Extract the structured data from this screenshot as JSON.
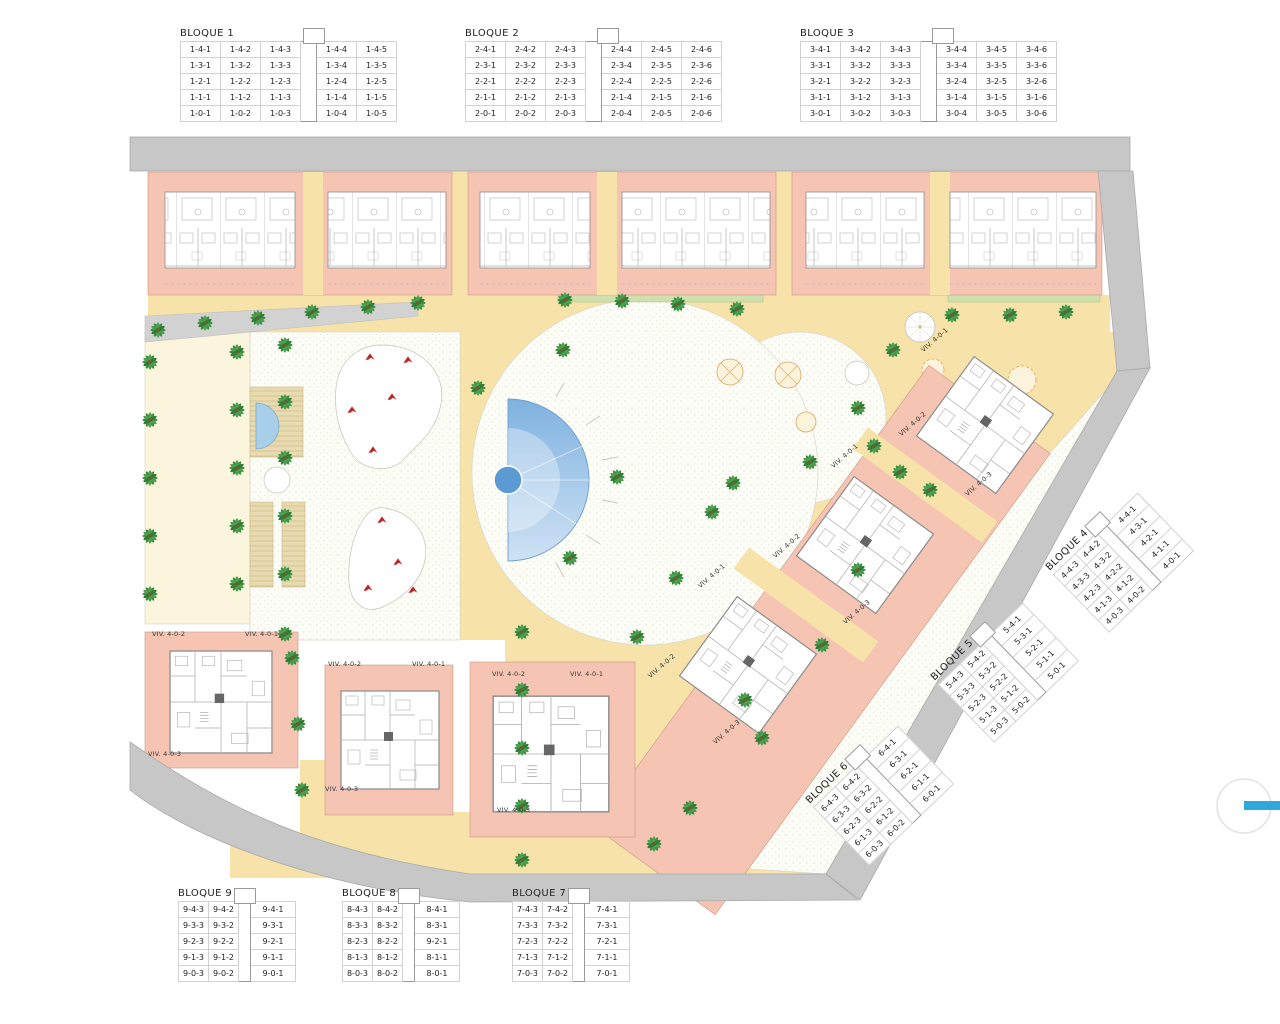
{
  "palette": {
    "pink": "#f6c4b2",
    "sand": "#f7e3a9",
    "road": "#c7c7c7",
    "lawn": "#fbf5dd",
    "deck": "#e9dbb0",
    "hedge": "#cde0ae",
    "pool_dark": "#7fb2e0",
    "pool_light": "#cfe2f4",
    "palm_green": "#3e8e41",
    "play_red": "#c22222",
    "accent_blue": "#2fa8dd"
  },
  "tables": [
    {
      "id": "b1",
      "title": "BLOQUE 1",
      "kind": "wide",
      "gap_after": 3,
      "rows": [
        [
          "1-4-1",
          "1-4-2",
          "1-4-3",
          "1-4-4",
          "1-4-5"
        ],
        [
          "1-3-1",
          "1-3-2",
          "1-3-3",
          "1-3-4",
          "1-3-5"
        ],
        [
          "1-2-1",
          "1-2-2",
          "1-2-3",
          "1-2-4",
          "1-2-5"
        ],
        [
          "1-1-1",
          "1-1-2",
          "1-1-3",
          "1-1-4",
          "1-1-5"
        ],
        [
          "1-0-1",
          "1-0-2",
          "1-0-3",
          "1-0-4",
          "1-0-5"
        ]
      ]
    },
    {
      "id": "b2",
      "title": "BLOQUE 2",
      "kind": "wide",
      "gap_after": 3,
      "rows": [
        [
          "2-4-1",
          "2-4-2",
          "2-4-3",
          "2-4-4",
          "2-4-5",
          "2-4-6"
        ],
        [
          "2-3-1",
          "2-3-2",
          "2-3-3",
          "2-3-4",
          "2-3-5",
          "2-3-6"
        ],
        [
          "2-2-1",
          "2-2-2",
          "2-2-3",
          "2-2-4",
          "2-2-5",
          "2-2-6"
        ],
        [
          "2-1-1",
          "2-1-2",
          "2-1-3",
          "2-1-4",
          "2-1-5",
          "2-1-6"
        ],
        [
          "2-0-1",
          "2-0-2",
          "2-0-3",
          "2-0-4",
          "2-0-5",
          "2-0-6"
        ]
      ]
    },
    {
      "id": "b3",
      "title": "BLOQUE 3",
      "kind": "wide",
      "gap_after": 3,
      "rows": [
        [
          "3-4-1",
          "3-4-2",
          "3-4-3",
          "3-4-4",
          "3-4-5",
          "3-4-6"
        ],
        [
          "3-3-1",
          "3-3-2",
          "3-3-3",
          "3-3-4",
          "3-3-5",
          "3-3-6"
        ],
        [
          "3-2-1",
          "3-2-2",
          "3-2-3",
          "3-2-4",
          "3-2-5",
          "3-2-6"
        ],
        [
          "3-1-1",
          "3-1-2",
          "3-1-3",
          "3-1-4",
          "3-1-5",
          "3-1-6"
        ],
        [
          "3-0-1",
          "3-0-2",
          "3-0-3",
          "3-0-4",
          "3-0-5",
          "3-0-6"
        ]
      ]
    },
    {
      "id": "b4",
      "title": "BLOQUE 4",
      "kind": "small",
      "gap_after": 2,
      "rows": [
        [
          "4-4-3",
          "4-4-2",
          "4-4-1"
        ],
        [
          "4-3-3",
          "4-3-2",
          "4-3-1"
        ],
        [
          "4-2-3",
          "4-2-2",
          "4-2-1"
        ],
        [
          "4-1-3",
          "4-1-2",
          "4-1-1"
        ],
        [
          "4-0-3",
          "4-0-2",
          "4-0-1"
        ]
      ]
    },
    {
      "id": "b5",
      "title": "BLOQUE 5",
      "kind": "small",
      "gap_after": 2,
      "rows": [
        [
          "5-4-3",
          "5-4-2",
          "5-4-1"
        ],
        [
          "5-3-3",
          "5-3-2",
          "5-3-1"
        ],
        [
          "5-2-3",
          "5-2-2",
          "5-2-1"
        ],
        [
          "5-1-3",
          "5-1-2",
          "5-1-1"
        ],
        [
          "5-0-3",
          "5-0-2",
          "5-0-1"
        ]
      ]
    },
    {
      "id": "b6",
      "title": "BLOQUE 6",
      "kind": "small",
      "gap_after": 2,
      "rows": [
        [
          "6-4-3",
          "6-4-2",
          "6-4-1"
        ],
        [
          "6-3-3",
          "6-3-2",
          "6-3-1"
        ],
        [
          "6-2-3",
          "6-2-2",
          "6-2-1"
        ],
        [
          "6-1-3",
          "6-1-2",
          "6-1-1"
        ],
        [
          "6-0-3",
          "6-0-2",
          "6-0-1"
        ]
      ]
    },
    {
      "id": "b7",
      "title": "BLOQUE 7",
      "kind": "small",
      "gap_after": 2,
      "rows": [
        [
          "7-4-3",
          "7-4-2",
          "7-4-1"
        ],
        [
          "7-3-3",
          "7-3-2",
          "7-3-1"
        ],
        [
          "7-2-3",
          "7-2-2",
          "7-2-1"
        ],
        [
          "7-1-3",
          "7-1-2",
          "7-1-1"
        ],
        [
          "7-0-3",
          "7-0-2",
          "7-0-1"
        ]
      ]
    },
    {
      "id": "b8",
      "title": "BLOQUE 8",
      "kind": "small",
      "gap_after": 2,
      "rows": [
        [
          "8-4-3",
          "8-4-2",
          "8-4-1"
        ],
        [
          "8-3-3",
          "8-3-2",
          "8-3-1"
        ],
        [
          "8-2-3",
          "8-2-2",
          "9-2-1"
        ],
        [
          "8-1-3",
          "8-1-2",
          "8-1-1"
        ],
        [
          "8-0-3",
          "8-0-2",
          "8-0-1"
        ]
      ]
    },
    {
      "id": "b9",
      "title": "BLOQUE 9",
      "kind": "small",
      "gap_after": 2,
      "rows": [
        [
          "9-4-3",
          "9-4-2",
          "9-4-1"
        ],
        [
          "9-3-3",
          "9-3-2",
          "9-3-1"
        ],
        [
          "9-2-3",
          "9-2-2",
          "9-2-1"
        ],
        [
          "9-1-3",
          "9-1-2",
          "9-1-1"
        ],
        [
          "9-0-3",
          "9-0-2",
          "9-0-1"
        ]
      ]
    }
  ],
  "plan": {
    "villa_labels": [
      "VIV. 4-0-2",
      "VIV. 4-0-1",
      "VIV. 4-0-3",
      "VIV. 4-0-2",
      "VIV. 4-0-1",
      "VIV. 4-0-3",
      "VIV. 4-0-2",
      "VIV. 4-0-1",
      "VIV. 4-0-3",
      "VIV. 4-0-1",
      "VIV. 4-0-2",
      "VIV. 4-0-3",
      "VIV. 4-0-1",
      "VIV. 4-0-2",
      "VIV. 4-0-3",
      "VIV. 4-0-1",
      "VIV. 4-0-2",
      "VIV. 4-0-3"
    ]
  }
}
